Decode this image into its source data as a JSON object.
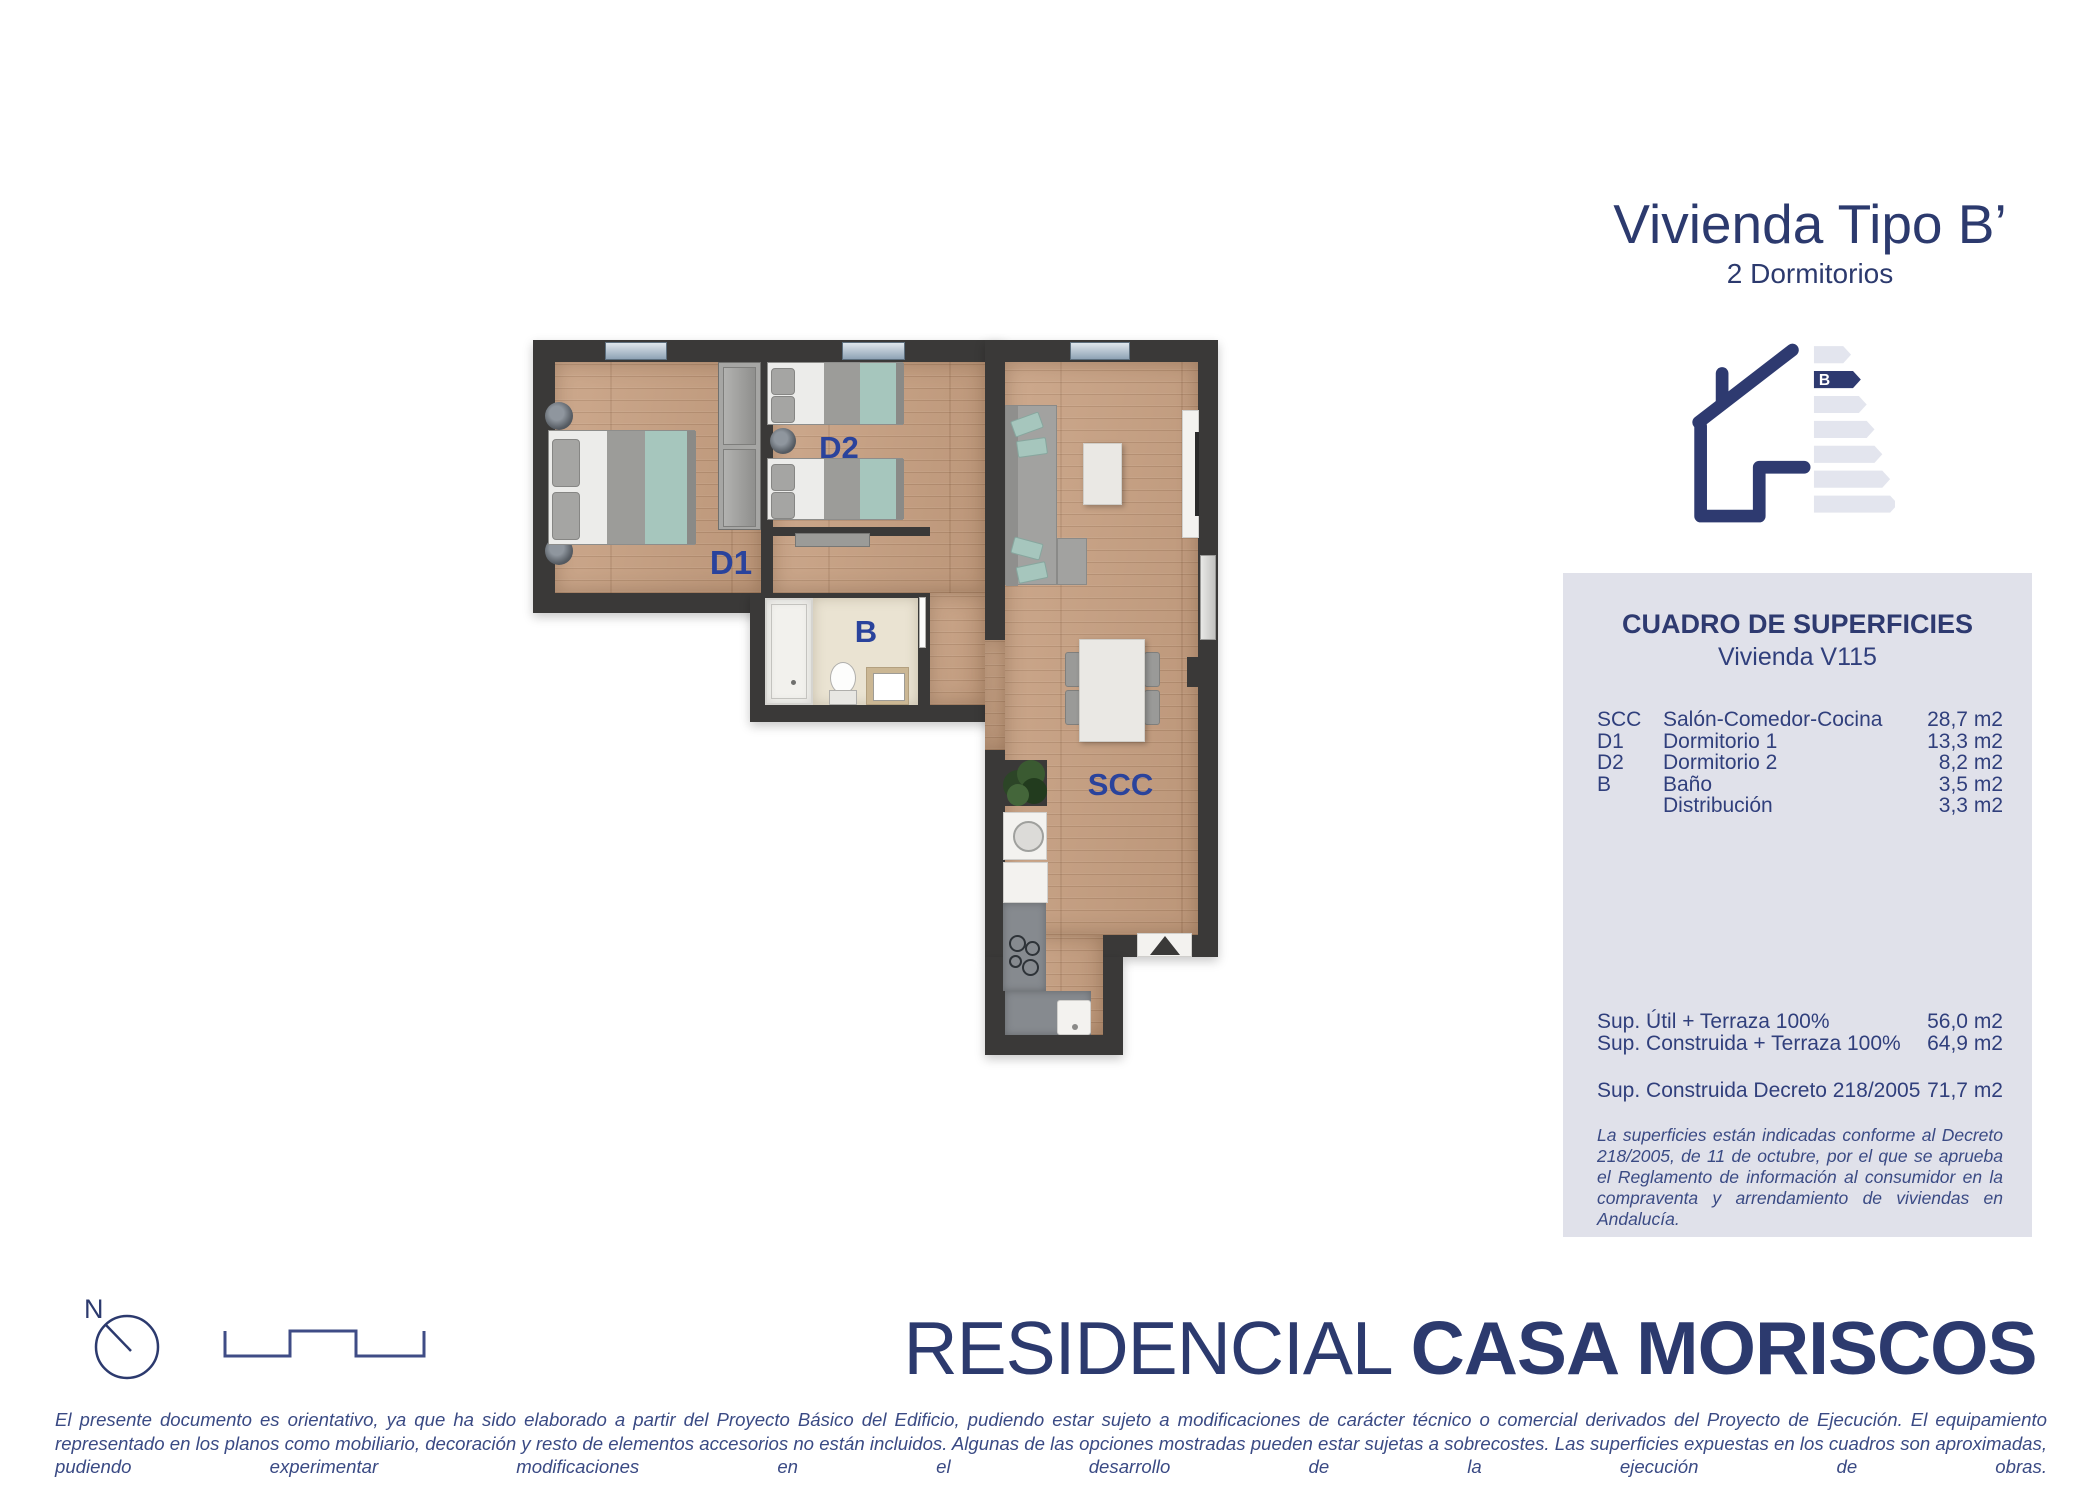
{
  "header": {
    "title": "Vivienda Tipo B’",
    "subtitle": "2 Dormitorios"
  },
  "energy": {
    "rating": "B"
  },
  "panel": {
    "title": "CUADRO DE SUPERFICIES",
    "subtitle": "Vivienda V115",
    "rows": [
      {
        "abbr": "SCC",
        "name": "Salón-Comedor-Cocina",
        "value": "28,7 m2"
      },
      {
        "abbr": "D1",
        "name": "Dormitorio 1",
        "value": "13,3 m2"
      },
      {
        "abbr": "D2",
        "name": "Dormitorio 2",
        "value": "8,2 m2"
      },
      {
        "abbr": "B",
        "name": "Baño",
        "value": "3,5 m2"
      },
      {
        "abbr": "",
        "name": "Distribución",
        "value": "3,3 m2"
      }
    ],
    "totals": [
      {
        "label": "Sup. Útil + Terraza 100%",
        "value": "56,0 m2"
      },
      {
        "label": "Sup. Construida + Terraza 100%",
        "value": "64,9 m2"
      }
    ],
    "decree": {
      "label": "Sup. Construida Decreto 218/2005",
      "value": "71,7 m2"
    },
    "note": "La superficies están indicadas conforme al Decreto 218/2005, de 11 de octubre, por el que se aprueba el Reglamento de información al consumidor en la compraventa y arrendamiento de viviendas en Andalucía."
  },
  "plan": {
    "labels": {
      "d1": "D1",
      "d2": "D2",
      "b": "B",
      "scc": "SCC"
    },
    "compass": "N"
  },
  "brand": {
    "prefix": "RESIDENCIAL",
    "name": "CASA MORISCOS"
  },
  "footer": {
    "disclaimer": "El presente documento es orientativo, ya que ha sido elaborado a partir del Proyecto Básico del Edificio, pudiendo estar sujeto a modificaciones de carácter técnico o comercial derivados del Proyecto de Ejecución. El equipamiento representado en los planos como mobiliario, decoración y resto de elementos accesorios no están incluidos. Algunas de las opciones mostradas pueden estar sujetas a sobrecostes. Las superficies expuestas en los cuadros son aproximadas, pudiendo experimentar modificaciones en el desarrollo de la ejecución de obras."
  },
  "colors": {
    "navy": "#2c3a6e",
    "label_blue": "#2a439c",
    "panel_bg": "#e0e1ea",
    "teal": "#a6c6bd",
    "wood": "#c79f80",
    "wall": "#3a3938",
    "energy_bar_gray": "#e3e5ee"
  }
}
